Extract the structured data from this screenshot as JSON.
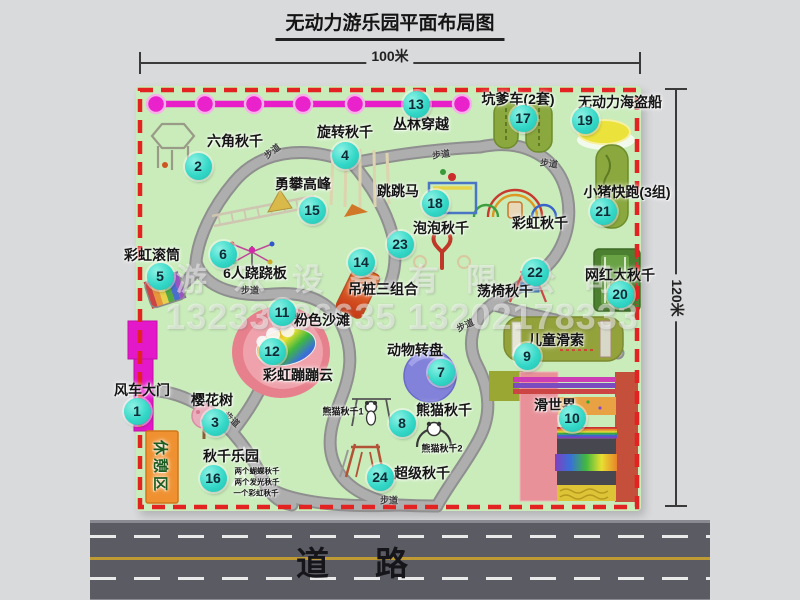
{
  "title": "无动力游乐园平面布局图",
  "dimensions": {
    "width_label": "100米",
    "height_label": "120米"
  },
  "road": {
    "label": "道路"
  },
  "watermark": {
    "company": "游乐设备有限公司",
    "phone": "13233886635 13202178333"
  },
  "colors": {
    "map_green": "#c9ecba",
    "border_red": "#e32222",
    "marker_cyan": "#35d8c8",
    "chain_magenta": "#e81ec8",
    "road_gray": "#5b5b64",
    "path_gray": "#a6a6a6",
    "rest_area_orange": "#ef9130",
    "beach_pink": "#e7808d"
  },
  "map": {
    "markers": [
      {
        "n": "1"
      },
      {
        "n": "2"
      },
      {
        "n": "3"
      },
      {
        "n": "4"
      },
      {
        "n": "5"
      },
      {
        "n": "6"
      },
      {
        "n": "7"
      },
      {
        "n": "8"
      },
      {
        "n": "9"
      },
      {
        "n": "10"
      },
      {
        "n": "11"
      },
      {
        "n": "12"
      },
      {
        "n": "13"
      },
      {
        "n": "14"
      },
      {
        "n": "15"
      },
      {
        "n": "16"
      },
      {
        "n": "17"
      },
      {
        "n": "18"
      },
      {
        "n": "19"
      },
      {
        "n": "20"
      },
      {
        "n": "21"
      },
      {
        "n": "22"
      },
      {
        "n": "23"
      },
      {
        "n": "24"
      }
    ],
    "labels": [
      {
        "text": "丛林穿越"
      },
      {
        "text": "六角秋千"
      },
      {
        "text": "旋转秋千"
      },
      {
        "text": "坑爹车(2套)"
      },
      {
        "text": "无动力海盗船"
      },
      {
        "text": "小猪快跑(3组)"
      },
      {
        "text": "彩虹秋千"
      },
      {
        "text": "勇攀高峰"
      },
      {
        "text": "跳跳马"
      },
      {
        "text": "泡泡秋千"
      },
      {
        "text": "6人跷跷板"
      },
      {
        "text": "彩虹滚筒"
      },
      {
        "text": "吊桩三组合"
      },
      {
        "text": "粉色沙滩"
      },
      {
        "text": "动物转盘"
      },
      {
        "text": "网红大秋千"
      },
      {
        "text": "荡椅秋千"
      },
      {
        "text": "儿童滑索"
      },
      {
        "text": "彩虹蹦蹦云"
      },
      {
        "text": "熊猫秋千"
      },
      {
        "text": "超级秋千"
      },
      {
        "text": "滑世界"
      },
      {
        "text": "风车大门"
      },
      {
        "text": "樱花树"
      },
      {
        "text": "秋千乐园"
      },
      {
        "text": "熊猫秋千1"
      },
      {
        "text": "熊猫秋千2"
      },
      {
        "text": "两个蝴蝶秋千"
      },
      {
        "text": "两个发光秋千"
      },
      {
        "text": "一个彩虹秋千"
      },
      {
        "text": "休憩区"
      }
    ],
    "path_labels": [
      "步道",
      "步道",
      "步道",
      "步道",
      "步道",
      "步道",
      "步道"
    ]
  }
}
